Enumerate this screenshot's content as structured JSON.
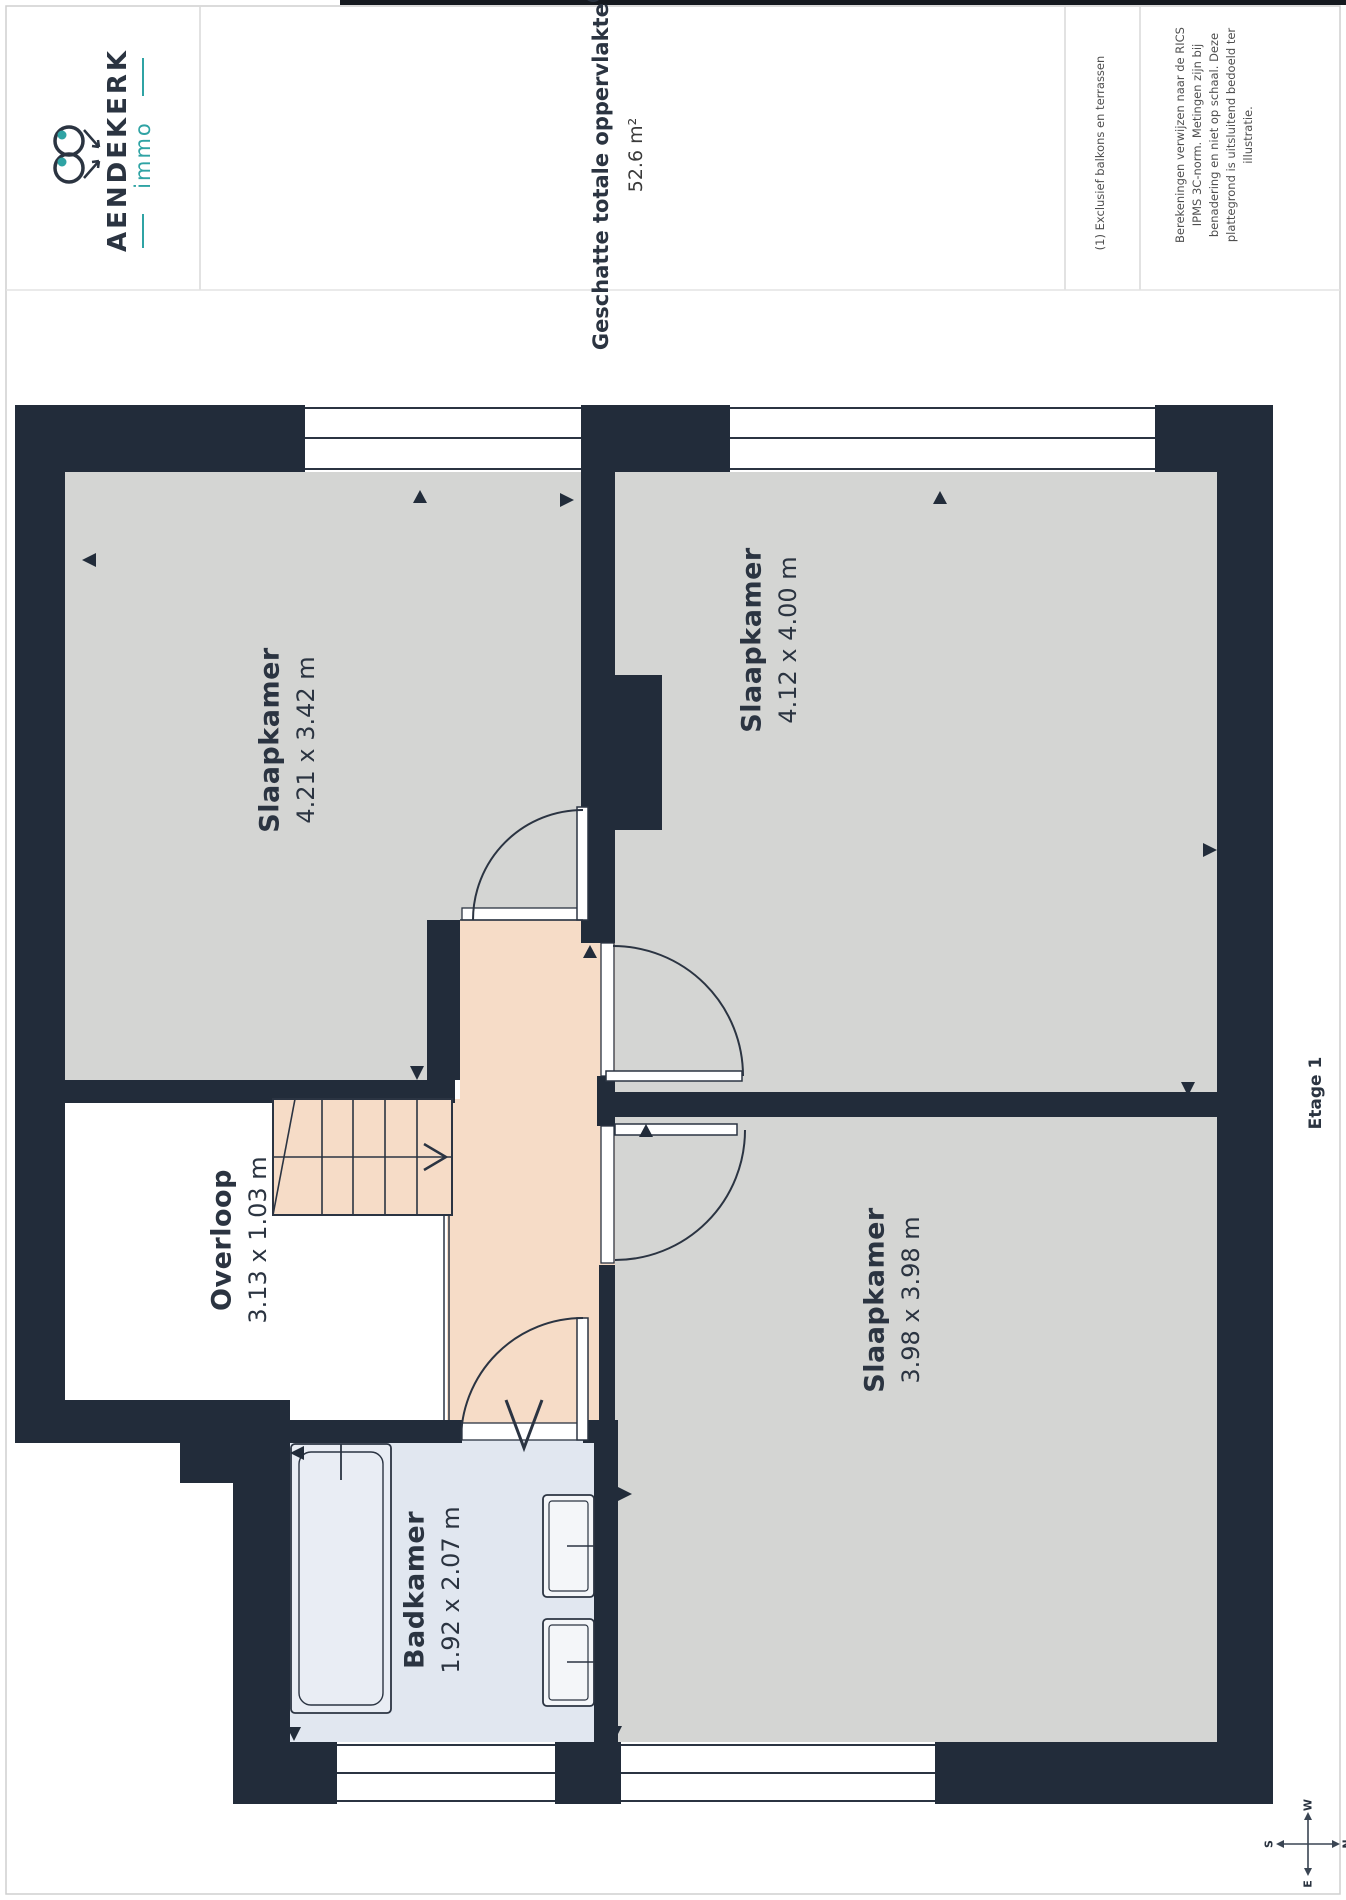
{
  "header": {
    "logo": {
      "brand": "AENDEKERK",
      "sub": "immo"
    },
    "title": "Geschatte totale oppervlakte",
    "title_sup": "(1)",
    "total_area": "52.6 m²",
    "footnote1": "(1) Exclusief balkons en terrassen",
    "footnote2_lines": [
      "Berekeningen verwijzen naar de RICS",
      "IPMS 3C-norm. Metingen zijn bij",
      "benadering en niet op schaal. Deze",
      "plattegrond is uitsluitend bedoeld ter",
      "illustratie."
    ]
  },
  "floor_label": "Etage 1",
  "rooms": [
    {
      "name": "Slaapkamer",
      "dimensions": "4.21 x 3.42 m"
    },
    {
      "name": "Slaapkamer",
      "dimensions": "4.12 x 4.00 m"
    },
    {
      "name": "Slaapkamer",
      "dimensions": "3.98 x 3.98 m"
    },
    {
      "name": "Overloop",
      "dimensions": "3.13 x 1.03 m"
    },
    {
      "name": "Badkamer",
      "dimensions": "1.92 x 2.07 m"
    }
  ],
  "compass": {
    "n": "N",
    "e": "E",
    "s": "S",
    "w": "W"
  },
  "colors": {
    "wall": "#222c3a",
    "room_fill": "#d4d5d3",
    "hall_fill": "#f6dcc7",
    "bath_fill": "#e1e7f0",
    "accent_teal": "#2fa3a4"
  }
}
